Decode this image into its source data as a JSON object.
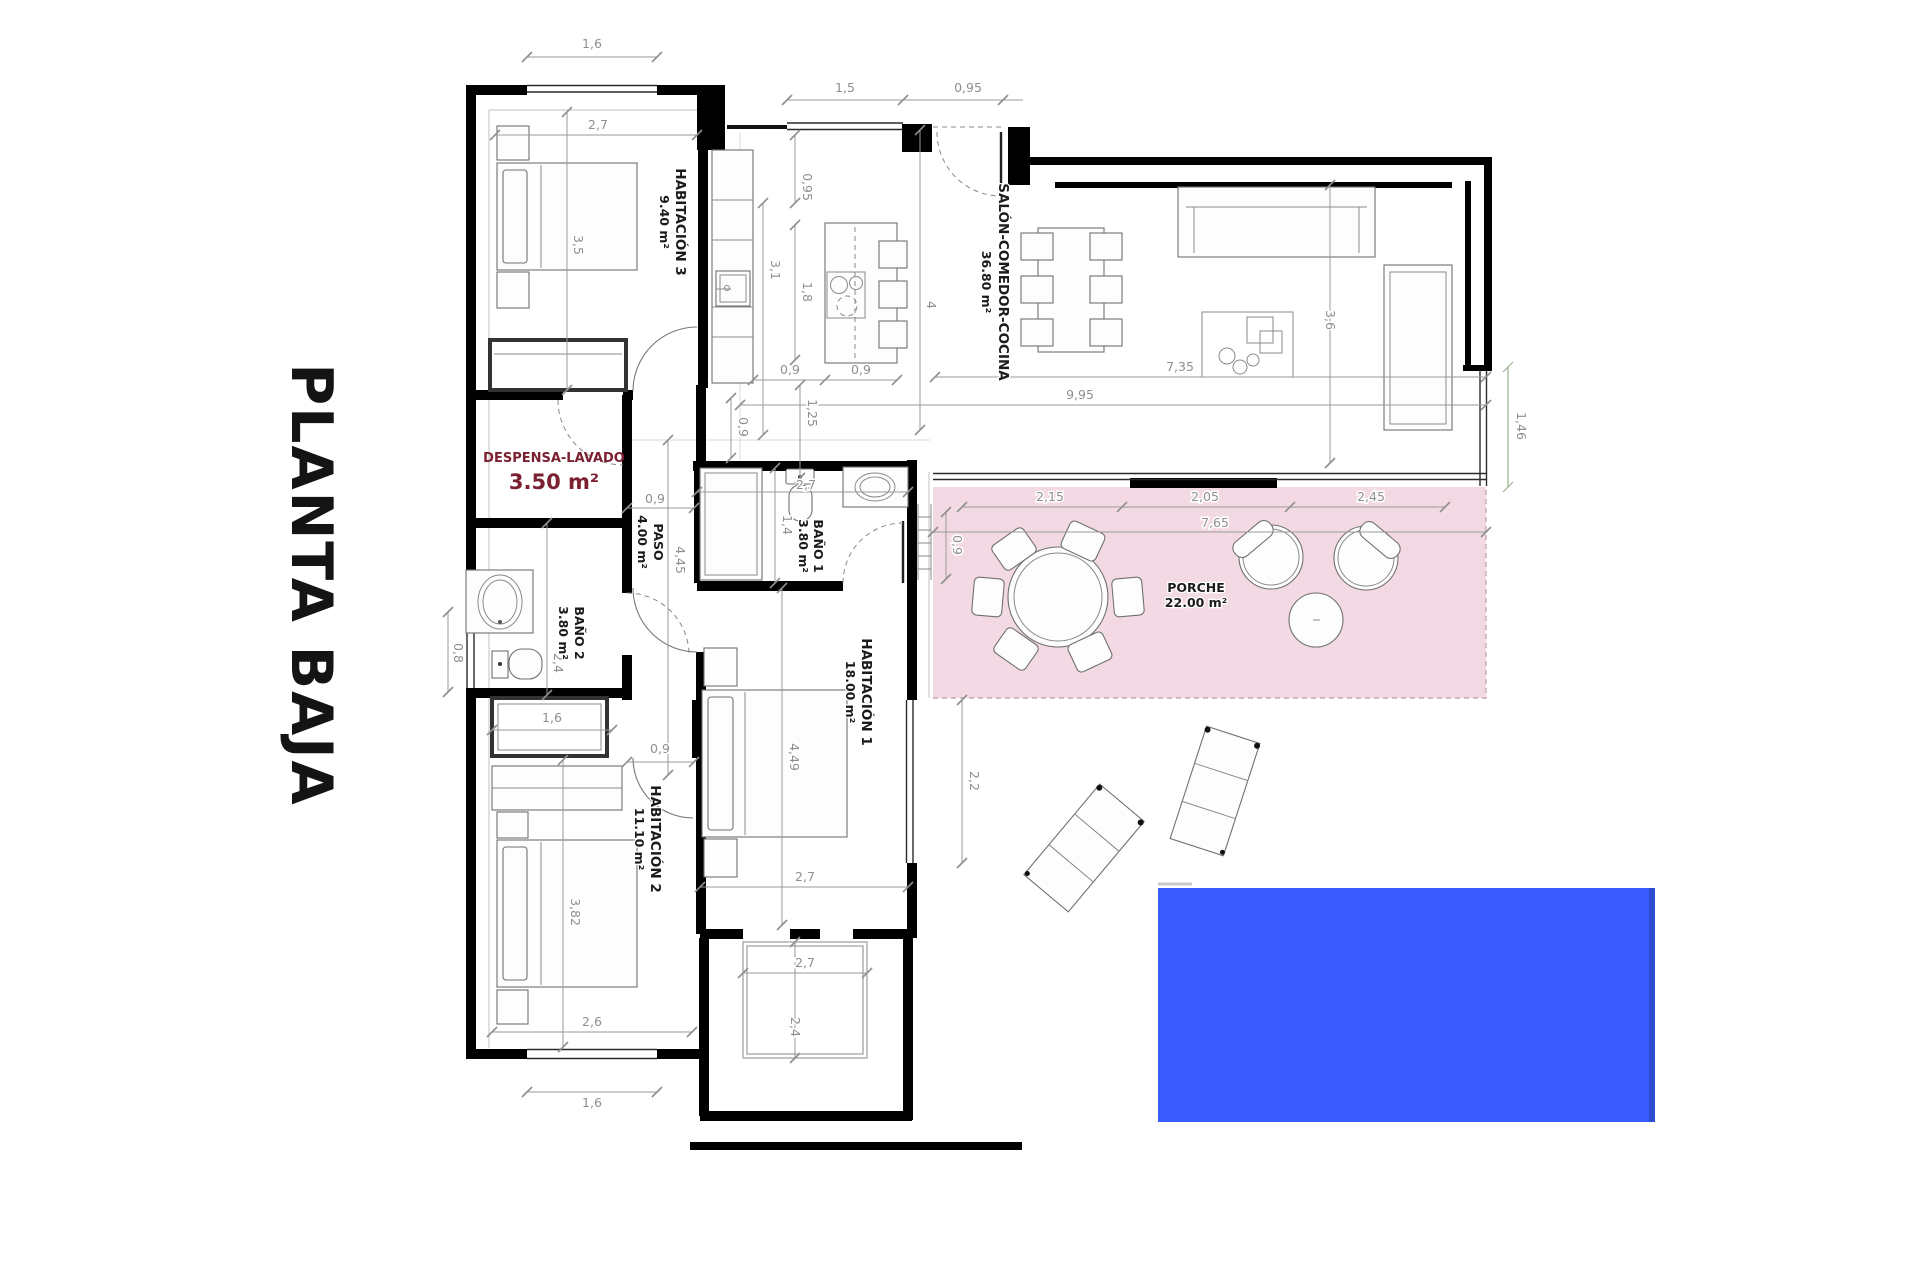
{
  "title": "PLANTA BAJA",
  "colors": {
    "pool": "#3a5bfe",
    "pool_edge": "#2d4bd1",
    "porch": "#f3d9e4",
    "despensa_label": "#7b2030"
  },
  "rooms": {
    "hab3": {
      "name": "HABITACIÓN 3",
      "area": "9.40 m²"
    },
    "salon": {
      "name": "SALÓN-COMEDOR-COCINA",
      "area": "36.80 m²"
    },
    "despensa": {
      "name": "DESPENSA-LAVADO",
      "area": "3.50 m²"
    },
    "paso": {
      "name": "PASO",
      "area": "4.00 m²"
    },
    "bano1": {
      "name": "BAÑO 1",
      "area": "3.80 m²"
    },
    "bano2": {
      "name": "BAÑO 2",
      "area": "3.80 m²"
    },
    "hab1": {
      "name": "HABITACIÓN 1",
      "area": "18.00 m²"
    },
    "hab2": {
      "name": "HABITACIÓN 2",
      "area": "11.10 m²"
    },
    "porche": {
      "name": "PORCHE",
      "area": "22.00 m²"
    }
  },
  "dims": {
    "top_16": "1,6",
    "top_15": "1,5",
    "top_095": "0,95",
    "hab3_w": "2,7",
    "hab3_h": "3,5",
    "k_095": "0,95",
    "k_31": "3,1",
    "k_18": "1,8",
    "k_4": "4",
    "k_09a": "0,9",
    "k_09b": "0,9",
    "k_125": "1,25",
    "paso_09": "0,9",
    "paso_09b": "0,9",
    "paso_445": "4,45",
    "salon_995": "9,95",
    "salon_735": "7,35",
    "salon_36": "3,6",
    "right_146": "1,46",
    "bano1_27": "2,7",
    "bano1_14": "1,4",
    "porch_215": "2,15",
    "porch_205": "2,05",
    "porch_245": "2,45",
    "porch_765": "7,65",
    "porch_09": "0,9",
    "hab1_449": "4,49",
    "hab1_27": "2,7",
    "hab1_22": "2,2",
    "terr_27": "2,7",
    "terr_24": "2,4",
    "bano2_24": "2,4",
    "bano2_08": "0,8",
    "bano2_16": "1,6",
    "hab2_09": "0,9",
    "hab2_382": "3,82",
    "hab2_26": "2,6",
    "bottom_16": "1,6"
  }
}
